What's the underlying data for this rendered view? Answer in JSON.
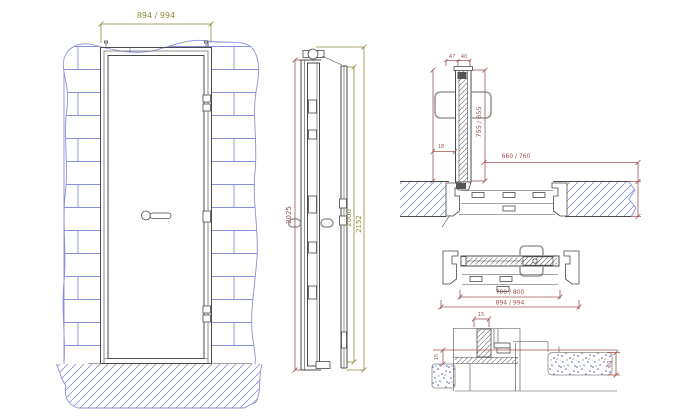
{
  "drawing": {
    "front_elevation": {
      "dim_width": "894 / 994"
    },
    "side_section": {
      "dim_leaf": "2025",
      "dim_clear": "2000",
      "dim_overall": "2152"
    },
    "open_leaf_section": {
      "dim_a": "47",
      "dim_b": "40",
      "dim_leaf": "755 / 855",
      "dim_thickness": "18",
      "dim_clear": "660 / 760"
    },
    "closed_plan_section": {
      "dim_clear": "700 / 800",
      "dim_overall": "894 / 994"
    },
    "threshold_detail": {
      "dim_gap": "15",
      "dim_level": "15",
      "dim_floor": "30"
    }
  },
  "colors": {
    "line": "#4a4a4a",
    "wall": "#8a90d8",
    "dim-olive": "#8f8a3a",
    "dim-red": "#a05252",
    "handle": "#9a9a9a",
    "concrete": "#4a56c0",
    "bg": "#ffffff"
  }
}
